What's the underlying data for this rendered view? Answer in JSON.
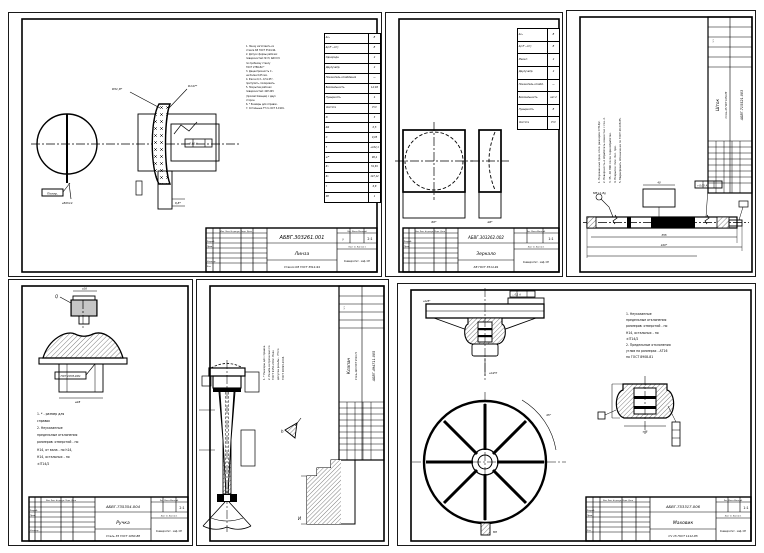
{
  "page": {
    "background": "#ffffff",
    "line_color": "#000000"
  },
  "titleblock": {
    "header_row": "Изм. Лист  № докум.  Подп.  Дата",
    "razrab": "Разраб.",
    "prov": "Пров.",
    "nkontr": "Н.контр.",
    "utv": "Утв.",
    "lit_row": "Лит.   Масса   Масштаб",
    "list_row": "Лист 1 | Листов 1"
  },
  "sheets": {
    "lens": {
      "number": "АБВГ.303261.001",
      "name": "Линза",
      "material": "Стекло К8 ГОСТ 3514-94",
      "scale": "2:1",
      "lit": "у",
      "org": "Университет · каф. ОП",
      "surface_note": "Полир.",
      "tol_box": "⌖  0,01  А",
      "r1_label": "R51,8*",
      "r2_label": "R147*",
      "under_label": "⌀50h14",
      "edge_dim": "6,8*",
      "notes": [
        "1. Линзу изготовить из",
        "стекла К8 ГОСТ 3514-94.",
        "2. Допуск формы рабочих",
        "поверхностей: N=3; ΔN=0,5",
        "по пробному стеклу",
        "ГОСТ 2786-82.*",
        "3. Децентричность С -",
        "не более 0,05 мм.",
        "4. Фаски 0,3...0,5×45°,",
        "притупить, полировать.",
        "5. Покрытие рабочих",
        "поверхностей: 42Р.245",
        "(просветляющее) с двух",
        "сторон.",
        "6. * Размеры для справок.",
        "7. Остальные ТТ по ОСТ 3-1901."
      ],
      "spec_rows": [
        [
          "Δnₑ",
          "В"
        ],
        [
          "Δ(nF′−nC′)",
          "В"
        ],
        [
          "Однородн.",
          "2"
        ],
        [
          "Двулучепр.",
          "2"
        ],
        [
          "Показатель ослабления",
          "—"
        ],
        [
          "Бессвильность",
          "1А;1Б"
        ],
        [
          "Пузырность",
          "4"
        ],
        [
          "Чистота",
          "Р IV"
        ],
        [
          "N",
          "3"
        ],
        [
          "ΔN",
          "0,5"
        ],
        [
          "С",
          "0,05"
        ],
        [
          "f′",
          "+102,1"
        ],
        [
          "s′F′",
          "96,4"
        ],
        [
          "R₁",
          "51,81"
        ],
        [
          "R₂",
          "147,12"
        ],
        [
          "t",
          "6,8"
        ],
        [
          "ΣВ",
          "1"
        ]
      ]
    },
    "mirror": {
      "number": "АБВГ.303262.002",
      "name": "Зеркало",
      "material": "К8 ГОСТ 3514-94",
      "scale": "1:1",
      "lit": "у",
      "org": "Университет · каф. ОП",
      "dim_front": "60*",
      "dim_side": "⌀6*",
      "spec_rows": [
        [
          "Δnₑ",
          "В"
        ],
        [
          "Δ(nF′−nC′)",
          "В"
        ],
        [
          "Масшт.",
          "2"
        ],
        [
          "Двулучепр.",
          "2"
        ],
        [
          "Показатель ослабл.",
          "—"
        ],
        [
          "Бессвильность",
          "кат.2"
        ],
        [
          "Пузырность",
          "В"
        ],
        [
          "Чистота",
          "Р IV"
        ]
      ]
    },
    "shaft": {
      "number": "АБВГ.715521.003",
      "name": "Шток",
      "material": "Сталь 45 ГОСТ 1050-88",
      "scale": "1:1",
      "box_label": "⌖  0,05  А",
      "dim_len": "420*",
      "dim_mid": "355",
      "dim_key": "40",
      "key_label": "М8×1-8g",
      "notes": [
        "1. Неуказанные пред. откл. размеров ±IT14/2.",
        "2. Поверхность А обработать совместно с поз. 2.",
        "3. 35...40 HRC после термообработки.",
        "4. Покрытие: Хим. Окс. прм.",
        "5. Маркировать обозначение по ГОСТ 26.008-85."
      ]
    },
    "knob": {
      "number": "АБВГ.735354.004",
      "name": "Ручка",
      "material": "Сталь 35 ГОСТ 1050-88",
      "scale": "2:1",
      "org": "Университет · каф. ОП",
      "q_label": "Q",
      "label_box": "ГОСТ 24705-2004",
      "dim_top": "⌀16",
      "dim_bottom": "⌀28",
      "notes": [
        "1. * - размер для",
        "справок",
        "2. Неуказанные",
        "предельные отклонения",
        "размеров: отверстий - по",
        "Н14, от вала - по h14,",
        "Н14, остальных - по",
        "±IT14/2"
      ]
    },
    "valve": {
      "number": "АБВГ.494711.005",
      "name": "Клапан",
      "material": "Сталь 40Х ГОСТ 4543-71",
      "scale": "1:1",
      "detail_h": "h",
      "detail_i": "И",
      "notes": [
        "1. * Размеры для справок.",
        "2. Резьба метрическая по",
        "ГОСТ 9150-2002. Поле",
        "допуска резьбы - 7Н по",
        "ГОСТ 16093-2004."
      ]
    },
    "handwheel": {
      "number": "АБВГ.753317.006",
      "name": "Маховик",
      "material": "СЧ 15 ГОСТ 1412-85",
      "scale": "1:1",
      "org": "Университет · каф. ОП",
      "box_label": "⌳ 0,1 А",
      "angle_label": "45°",
      "hub_dim": "⌀14H7",
      "rim_dim": "⌀125*",
      "detail_dim": "⌀48",
      "stub_label": "М8",
      "notes": [
        "1. Неуказанные",
        "предельные отклонения",
        "размеров: отверстий - по",
        "Н14, остальных - по",
        "±IT14/2",
        "2. Предельные отклонения",
        "углов на размерах - АТ16",
        "по ГОСТ 8908-81"
      ]
    }
  }
}
